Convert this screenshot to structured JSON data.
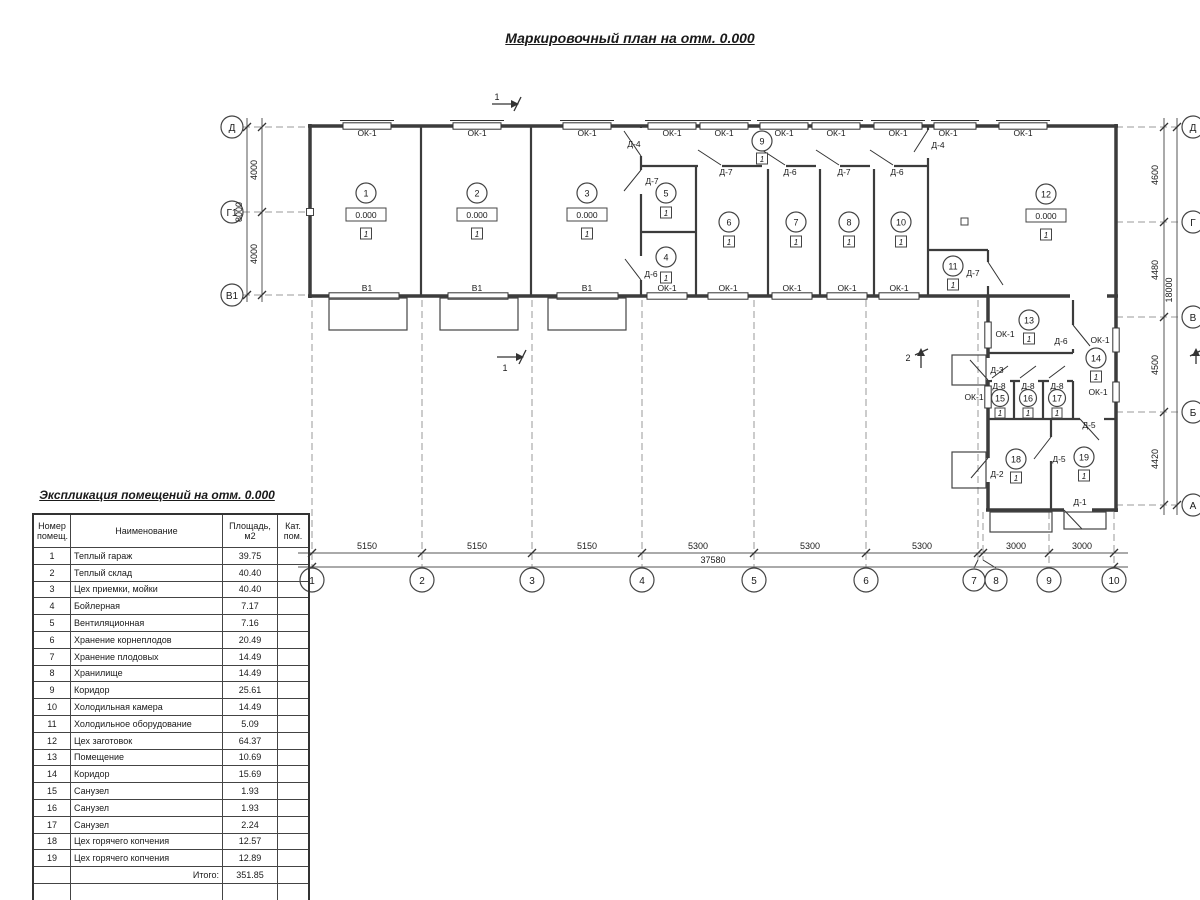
{
  "title": "Маркировочный план на отм. 0.000",
  "schedule": {
    "title": "Экспликация помещений на отм. 0.000",
    "headers": {
      "num": "Номер\nпомещ.",
      "name": "Наименование",
      "area": "Площадь,\nм2",
      "cat": "Кат.\nпом."
    },
    "rows": [
      {
        "num": "1",
        "name": "Теплый гараж",
        "area": "39.75",
        "cat": ""
      },
      {
        "num": "2",
        "name": "Теплый склад",
        "area": "40.40",
        "cat": ""
      },
      {
        "num": "3",
        "name": "Цех приемки, мойки",
        "area": "40.40",
        "cat": ""
      },
      {
        "num": "4",
        "name": "Бойлерная",
        "area": "7.17",
        "cat": ""
      },
      {
        "num": "5",
        "name": "Вентиляционная",
        "area": "7.16",
        "cat": ""
      },
      {
        "num": "6",
        "name": "Хранение корнеплодов",
        "area": "20.49",
        "cat": ""
      },
      {
        "num": "7",
        "name": "Хранение плодовых",
        "area": "14.49",
        "cat": ""
      },
      {
        "num": "8",
        "name": "Хранилище",
        "area": "14.49",
        "cat": ""
      },
      {
        "num": "9",
        "name": "Коридор",
        "area": "25.61",
        "cat": ""
      },
      {
        "num": "10",
        "name": "Холодильная камера",
        "area": "14.49",
        "cat": ""
      },
      {
        "num": "11",
        "name": "Холодильное оборудование",
        "area": "5.09",
        "cat": ""
      },
      {
        "num": "12",
        "name": "Цех заготовок",
        "area": "64.37",
        "cat": ""
      },
      {
        "num": "13",
        "name": "Помещение",
        "area": "10.69",
        "cat": ""
      },
      {
        "num": "14",
        "name": "Коридор",
        "area": "15.69",
        "cat": ""
      },
      {
        "num": "15",
        "name": "Санузел",
        "area": "1.93",
        "cat": ""
      },
      {
        "num": "16",
        "name": "Санузел",
        "area": "1.93",
        "cat": ""
      },
      {
        "num": "17",
        "name": "Санузел",
        "area": "2.24",
        "cat": ""
      },
      {
        "num": "18",
        "name": "Цех горячего копчения",
        "area": "12.57",
        "cat": ""
      },
      {
        "num": "19",
        "name": "Цех горячего копчения",
        "area": "12.89",
        "cat": ""
      }
    ],
    "total_label": "Итого:",
    "total_value": "351.85"
  },
  "axes": {
    "bottom": [
      "1",
      "2",
      "3",
      "4",
      "5",
      "6",
      "7",
      "8",
      "9",
      "10"
    ],
    "left": [
      "Д",
      "Г1",
      "В1"
    ],
    "right": [
      "Д",
      "Г",
      "В",
      "Б",
      "А"
    ]
  },
  "dims": {
    "bottom": [
      "5150",
      "5150",
      "5150",
      "5300",
      "5300",
      "5300",
      "3000",
      "3000"
    ],
    "bottom_total": "37580",
    "left": [
      "4000",
      "4000"
    ],
    "left_total": "8000",
    "right": [
      "4600",
      "4480",
      "4500",
      "4420"
    ],
    "right_total": "18000"
  },
  "plan": {
    "window_label": "ОК-1",
    "gate_label": "В1",
    "elevation": "0.000",
    "floor_type": "1",
    "doors": {
      "d1": "Д-1",
      "d2": "Д-2",
      "d3": "Д-3",
      "d4": "Д-4",
      "d5": "Д-5",
      "d6": "Д-6",
      "d7": "Д-7",
      "d8": "Д-8"
    },
    "sections": {
      "s1": "1",
      "s2": "2"
    }
  }
}
